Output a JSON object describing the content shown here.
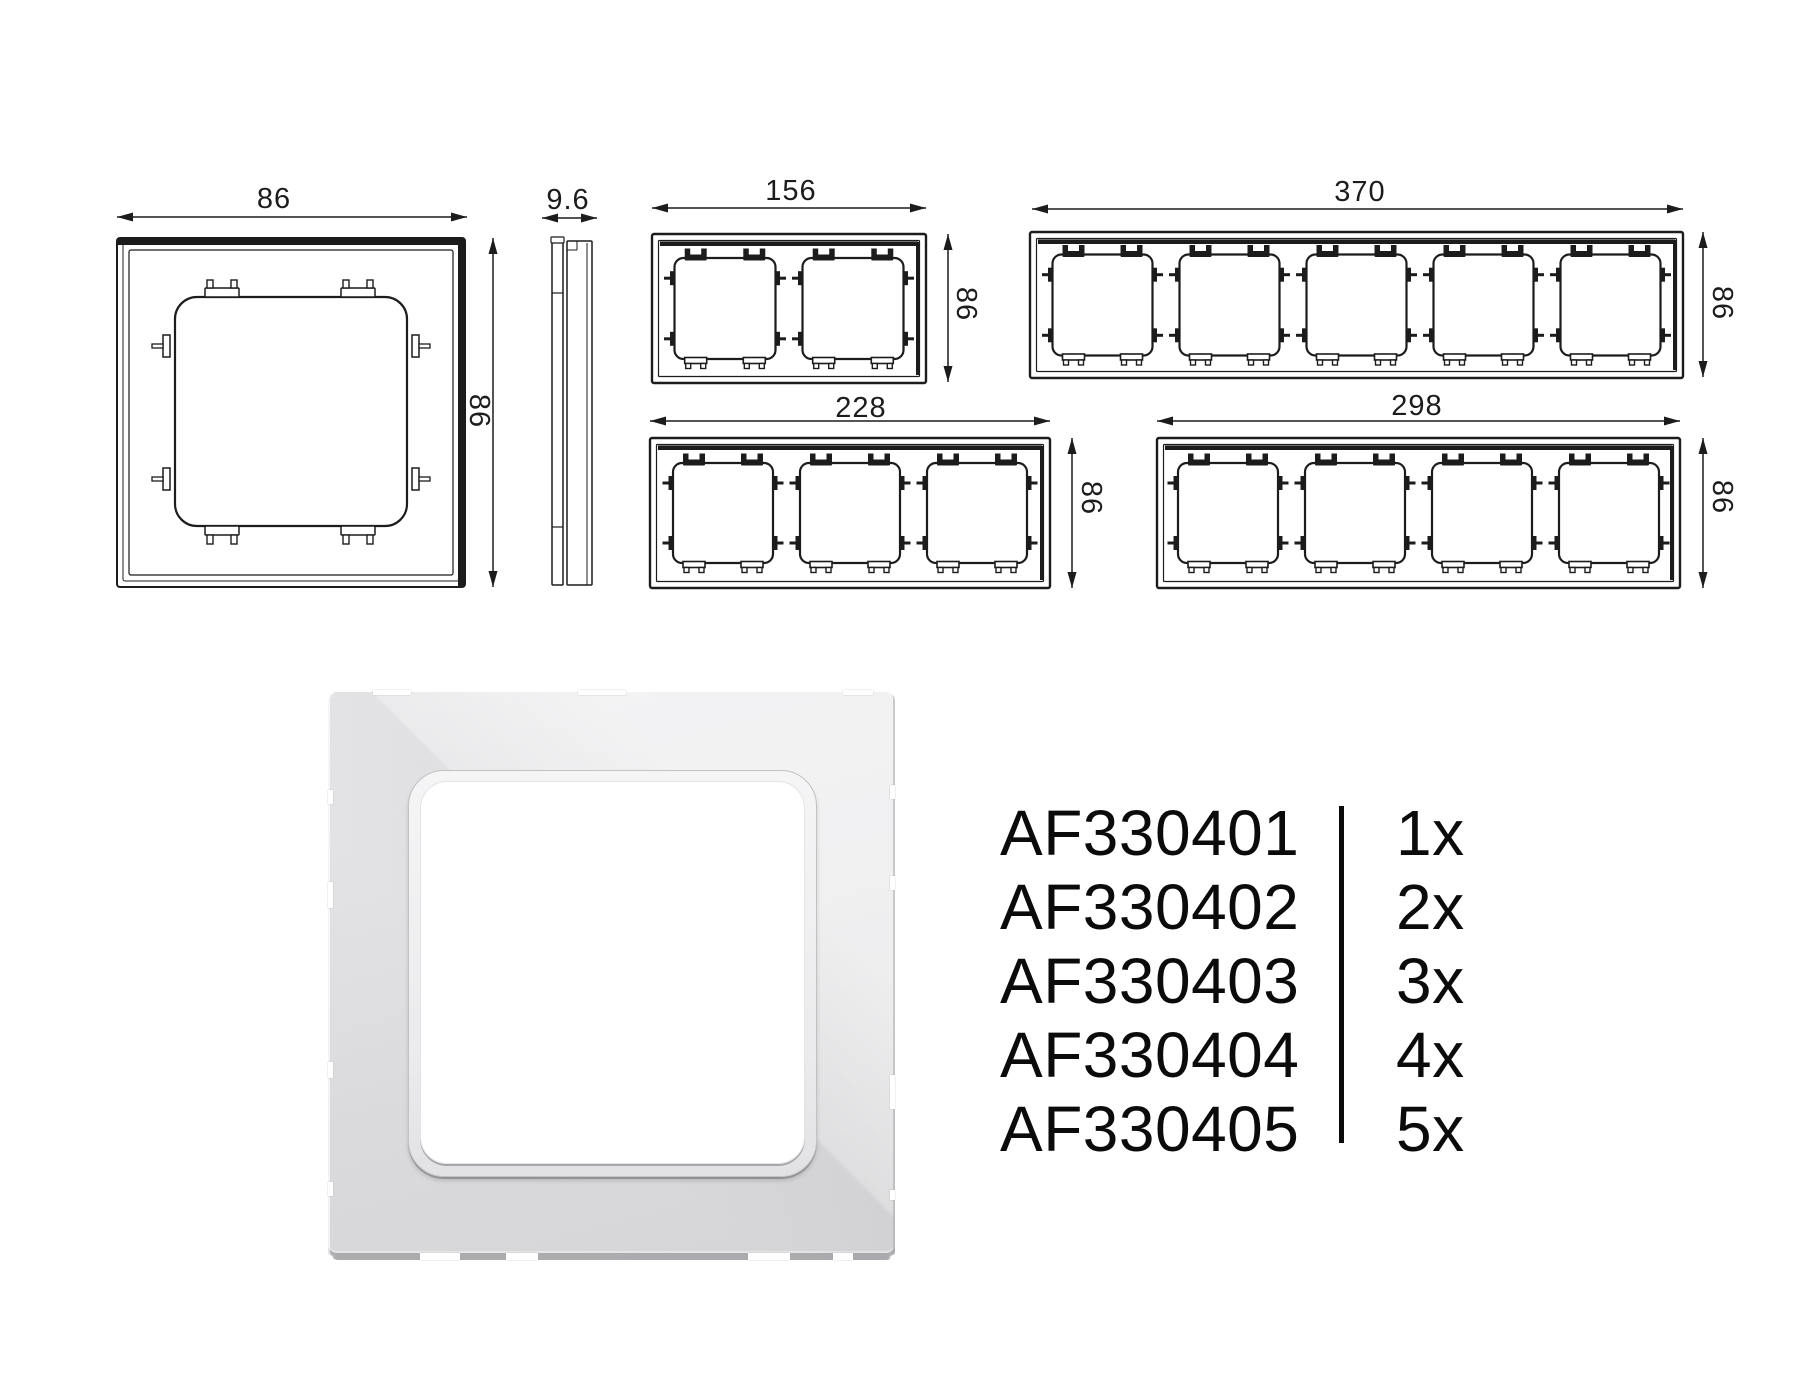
{
  "colors": {
    "background": "#ffffff",
    "line": "#1c1c1c",
    "text": "#0b0b0b",
    "render_base": "#dfdfe1",
    "render_opening": "#ffffff"
  },
  "technical_drawings": {
    "single_frame": {
      "width_label": "86",
      "height_label": "86"
    },
    "side_profile": {
      "depth_label": "9.6"
    },
    "frame_2gang": {
      "width_label": "156",
      "height_label": "86"
    },
    "frame_3gang": {
      "width_label": "228",
      "height_label": "86"
    },
    "frame_4gang": {
      "width_label": "298",
      "height_label": "86"
    },
    "frame_5gang": {
      "width_label": "370",
      "height_label": "86"
    }
  },
  "product_codes": {
    "rows": [
      {
        "code": "AF330401",
        "qty": "1x"
      },
      {
        "code": "AF330402",
        "qty": "2x"
      },
      {
        "code": "AF330403",
        "qty": "3x"
      },
      {
        "code": "AF330404",
        "qty": "4x"
      },
      {
        "code": "AF330405",
        "qty": "5x"
      }
    ]
  }
}
